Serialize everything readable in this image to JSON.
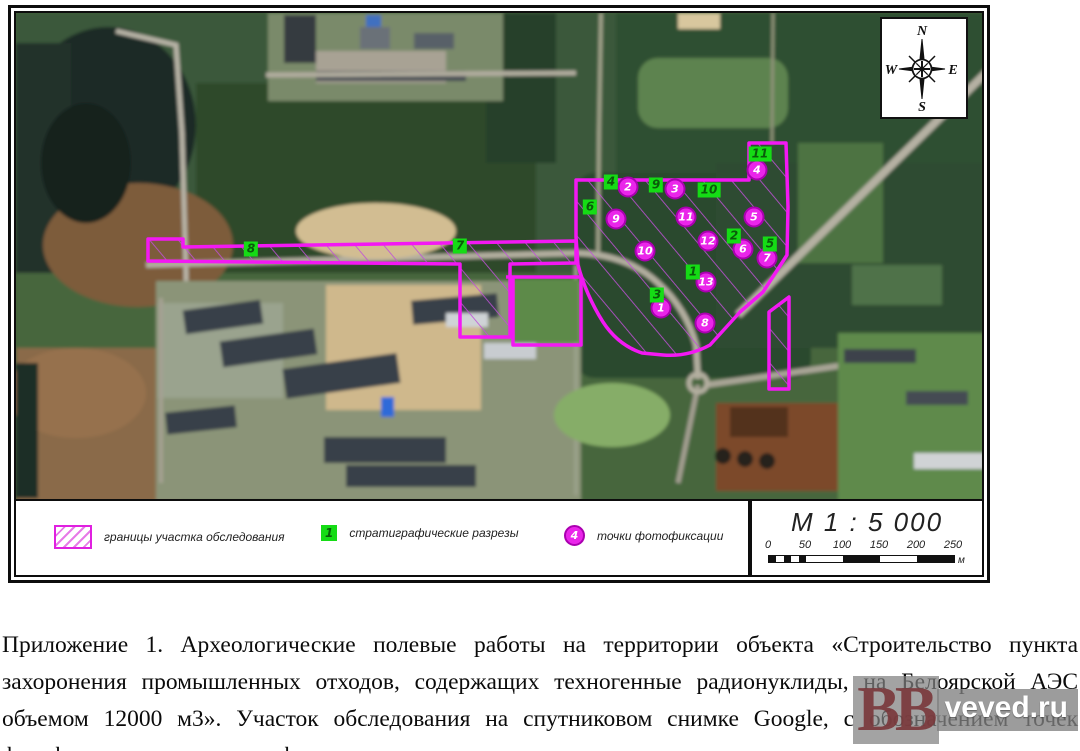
{
  "figure": {
    "compass": {
      "north": "N",
      "south": "S",
      "west": "W",
      "east": "E"
    },
    "scale": {
      "title": "М 1 : 5 000",
      "ticks": [
        "0",
        "50",
        "100",
        "150",
        "200",
        "250"
      ],
      "unit": "м"
    },
    "legend": {
      "items": [
        {
          "type": "hatched-area",
          "label": "границы участка обследования"
        },
        {
          "type": "green-square",
          "number": "1",
          "label": "стратиграфические разрезы"
        },
        {
          "type": "magenta-circle",
          "number": "4",
          "label": "точки фотофиксации"
        }
      ]
    },
    "map": {
      "sections": [
        {
          "id": "1",
          "x": 677,
          "y": 259
        },
        {
          "id": "2",
          "x": 718,
          "y": 223
        },
        {
          "id": "3",
          "x": 641,
          "y": 282
        },
        {
          "id": "4",
          "x": 595,
          "y": 169
        },
        {
          "id": "5",
          "x": 754,
          "y": 231
        },
        {
          "id": "6",
          "x": 574,
          "y": 194
        },
        {
          "id": "7",
          "x": 444,
          "y": 233
        },
        {
          "id": "8",
          "x": 235,
          "y": 236
        },
        {
          "id": "9",
          "x": 640,
          "y": 172
        },
        {
          "id": "10",
          "x": 693,
          "y": 177
        },
        {
          "id": "11",
          "x": 744,
          "y": 141
        }
      ],
      "photo_points": [
        {
          "id": "1",
          "x": 645,
          "y": 295
        },
        {
          "id": "2",
          "x": 612,
          "y": 174
        },
        {
          "id": "3",
          "x": 659,
          "y": 176
        },
        {
          "id": "4",
          "x": 741,
          "y": 157
        },
        {
          "id": "5",
          "x": 738,
          "y": 204
        },
        {
          "id": "6",
          "x": 727,
          "y": 236
        },
        {
          "id": "7",
          "x": 751,
          "y": 245
        },
        {
          "id": "8",
          "x": 689,
          "y": 310
        },
        {
          "id": "9",
          "x": 600,
          "y": 206
        },
        {
          "id": "10",
          "x": 629,
          "y": 238
        },
        {
          "id": "11",
          "x": 670,
          "y": 204
        },
        {
          "id": "12",
          "x": 692,
          "y": 228
        },
        {
          "id": "13",
          "x": 690,
          "y": 269
        }
      ]
    },
    "colors": {
      "boundary": "#f318f3",
      "hatch": "#c050d8",
      "section_fill": "#15dc15",
      "section_text": "#0a5c0a",
      "photo_fill": "#ea25ea",
      "photo_text": "#ffffff"
    }
  },
  "caption": {
    "text": "Приложение 1. Археологические полевые работы на территории объекта «Строительство пункта захоронения промышленных отходов, содержащих техногенные радионуклиды, на Белоярской АЭС объемом 12000 м3». Участок обследования на спутниковом снимке Google, с обозначением точек фотофиксации и стратиграфических разрезов."
  },
  "watermark": {
    "letters": "BB",
    "site": "veved.ru"
  }
}
